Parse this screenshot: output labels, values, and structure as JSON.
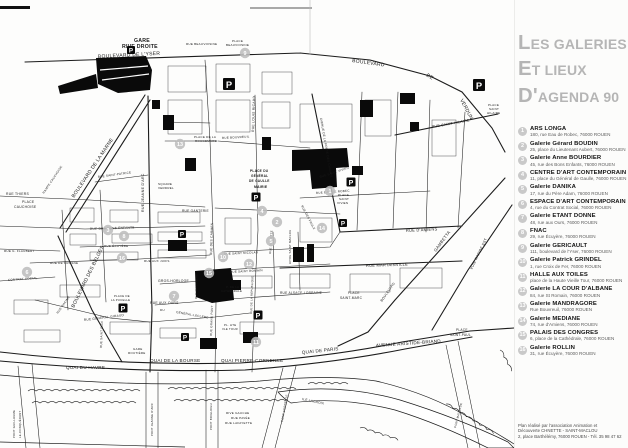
{
  "colors": {
    "ink": "#1c1c1c",
    "title_gray": "#b5b5b5",
    "marker_gray": "#bdbdbd",
    "legend_circle_gray": "#c9c9c9",
    "address_gray": "#5d5d5d",
    "parking_black": "#0a0a0a"
  },
  "page": {
    "title_lines": [
      "LES GALERIES",
      "ET LIEUX",
      "D'AGENDA 90"
    ],
    "credit_lines": [
      "Plan réalisé par l'association Animation et",
      "Découverte CHNETTE - SAINT-MACLOU",
      "2, place Barthélémy, 76000 ROUEN - Tél. 35 98 47 62"
    ]
  },
  "legend": {
    "entries": [
      {
        "num": "1",
        "name": "ARS LONGA",
        "address": "180, rue Eau de Robec, 76000 ROUEN"
      },
      {
        "num": "2",
        "name": "Galerie Gérard BOUDIN",
        "address": "25, place du Lieutenant Aubert, 76000 ROUEN"
      },
      {
        "num": "3",
        "name": "Galerie Anne BOURDIER",
        "address": "45, rue des Bons Enfants, 76000 ROUEN"
      },
      {
        "num": "4",
        "name": "CENTRE D'ART CONTEMPORAIN",
        "address": "11, place du Général de Gaulle, 76000 ROUEN"
      },
      {
        "num": "5",
        "name": "Galerie DANIKA",
        "address": "17, rue du Père Adam, 76000 ROUEN"
      },
      {
        "num": "6",
        "name": "ESPACE D'ART CONTEMPORAIN",
        "address": "4, rue du Contrat Social, 76000 ROUEN"
      },
      {
        "num": "7",
        "name": "Galerie ETANT DONNE",
        "address": "48, rue aux Ours, 76000 ROUEN"
      },
      {
        "num": "8",
        "name": "FNAC",
        "address": "29, rue Écuyère, 76000 ROUEN"
      },
      {
        "num": "9",
        "name": "Galerie GERICAULT",
        "address": "111, boulevard de l'Yser, 76000 ROUEN"
      },
      {
        "num": "10",
        "name": "Galerie Patrick GRINDEL",
        "address": "1, rue Croix de Fer, 76000 ROUEN"
      },
      {
        "num": "11",
        "name": "HALLE AUX TOILES",
        "address": "place de la Haute Vieille Tour, 76000 ROUEN"
      },
      {
        "num": "12",
        "name": "Galerie LA COUR D'ALBANE",
        "address": "84, rue St Romain, 76000 ROUEN"
      },
      {
        "num": "13",
        "name": "Galerie MANDRAGORE",
        "address": "Rue Bouvreuil, 76000 ROUEN"
      },
      {
        "num": "14",
        "name": "Galerie MEDIANE",
        "address": "74, rue d'Amiens, 76000 ROUEN"
      },
      {
        "num": "15",
        "name": "PALAIS DES CONGRES",
        "address": "6, place de la Cathédrale, 76000 ROUEN"
      },
      {
        "num": "16",
        "name": "Galerie ROLLIN",
        "address": "31, rue Écuyère, 76000 ROUEN"
      }
    ]
  },
  "map": {
    "parking_label": "P",
    "labels": [
      {
        "t": "GARE",
        "x": 134,
        "y": 42,
        "s": 5.2,
        "w": "bold"
      },
      {
        "t": "RIVE DROITE",
        "x": 122,
        "y": 48,
        "s": 5.2,
        "w": "bold"
      },
      {
        "t": "BOULEVARD DE L'YSER",
        "x": 98,
        "y": 58,
        "s": 5,
        "r": -3
      },
      {
        "t": "BOULEVARD",
        "x": 352,
        "y": 62,
        "s": 5,
        "r": 8
      },
      {
        "t": "DE",
        "x": 426,
        "y": 76,
        "s": 5,
        "r": 32
      },
      {
        "t": "VERDUN",
        "x": 460,
        "y": 100,
        "s": 5,
        "r": 62
      },
      {
        "t": "RUE BEAUVOISINE",
        "x": 186,
        "y": 45,
        "s": 3
      },
      {
        "t": "PLACE",
        "x": 232,
        "y": 42,
        "s": 3
      },
      {
        "t": "BEAUVOISINE",
        "x": 226,
        "y": 46,
        "s": 3
      },
      {
        "t": "BOULEVARD DE LA MARNE",
        "x": 74,
        "y": 198,
        "s": 5,
        "r": -56
      },
      {
        "t": "RAMPE CAUCHOISE",
        "x": 44,
        "y": 194,
        "s": 3,
        "r": -56
      },
      {
        "t": "PLACE",
        "x": 22,
        "y": 203,
        "s": 3.4
      },
      {
        "t": "CAUCHOISE",
        "x": 14,
        "y": 208,
        "s": 3.4
      },
      {
        "t": "BOULEVARD DES BELGES",
        "x": 74,
        "y": 308,
        "s": 5,
        "r": -64
      },
      {
        "t": "RUE JEANNE D'ARC",
        "x": 144,
        "y": 212,
        "s": 3.6,
        "r": -90
      },
      {
        "t": "RUE LOUIS RICARD",
        "x": 254,
        "y": 132,
        "s": 3.4,
        "r": -88
      },
      {
        "t": "AVENUE DE LA PORTE DES CHAMPS",
        "x": 320,
        "y": 118,
        "s": 3,
        "r": 80
      },
      {
        "t": "RUE SAINT HILAIRE",
        "x": 432,
        "y": 128,
        "s": 3.6,
        "r": -10
      },
      {
        "t": "PLACE",
        "x": 488,
        "y": 106,
        "s": 3
      },
      {
        "t": "SAINT",
        "x": 489,
        "y": 110,
        "s": 3
      },
      {
        "t": "HILAIRE",
        "x": 487,
        "y": 114,
        "s": 3
      },
      {
        "t": "PLACE DE LA",
        "x": 194,
        "y": 138,
        "s": 3
      },
      {
        "t": "ROUGEMARE",
        "x": 195,
        "y": 142,
        "s": 3
      },
      {
        "t": "RUE BOUVREUIL",
        "x": 222,
        "y": 139,
        "s": 3,
        "r": -3
      },
      {
        "t": "SQUARE",
        "x": 158,
        "y": 185,
        "s": 3
      },
      {
        "t": "VERDREL",
        "x": 158,
        "y": 189,
        "s": 3
      },
      {
        "t": "PLACE DU",
        "x": 250,
        "y": 172,
        "s": 3.2,
        "w": "bold"
      },
      {
        "t": "GÉNÉRAL",
        "x": 251,
        "y": 177,
        "s": 3.2,
        "w": "bold"
      },
      {
        "t": "DE GAULLE",
        "x": 249,
        "y": 182,
        "s": 3.2,
        "w": "bold"
      },
      {
        "t": "MAIRIE",
        "x": 254,
        "y": 188,
        "s": 3.4,
        "w": "bold"
      },
      {
        "t": "RUE THIERS",
        "x": 6,
        "y": 195,
        "s": 3.4
      },
      {
        "t": "RUE GANTERIE",
        "x": 182,
        "y": 212,
        "s": 3.2
      },
      {
        "t": "RUE SAINT-PATRICE",
        "x": 98,
        "y": 178,
        "s": 3,
        "r": -8
      },
      {
        "t": "RUE DES BONS ENFANTS",
        "x": 90,
        "y": 230,
        "s": 3.2,
        "r": -2
      },
      {
        "t": "RUE ÉCUYÈRE",
        "x": 104,
        "y": 247,
        "s": 3
      },
      {
        "t": "RUE AUX JUIFS",
        "x": 144,
        "y": 262,
        "s": 3
      },
      {
        "t": "RUE DE CROSNE",
        "x": 50,
        "y": 264,
        "s": 3
      },
      {
        "t": "RUE G. FLAUBERT",
        "x": 4,
        "y": 252,
        "s": 3
      },
      {
        "t": "CONTRAT SOCIAL",
        "x": 8,
        "y": 281,
        "s": 3,
        "r": -4
      },
      {
        "t": "RUE DES CARMES",
        "x": 212,
        "y": 255,
        "s": 3.2,
        "r": -88
      },
      {
        "t": "RUE DE LA RÉPUBLIQUE",
        "x": 252,
        "y": 314,
        "s": 2.8,
        "r": -88
      },
      {
        "t": "GROS-HORLOGE",
        "x": 158,
        "y": 282,
        "s": 3.4
      },
      {
        "t": "RUE AUX OURS",
        "x": 150,
        "y": 304,
        "s": 3.4
      },
      {
        "t": "RUE SAINT NICOLAS",
        "x": 224,
        "y": 255,
        "s": 3,
        "r": -3
      },
      {
        "t": "RUE SAINT ROMAIN",
        "x": 230,
        "y": 273,
        "s": 3,
        "r": -3
      },
      {
        "t": "RUE EAU DE ROBEC",
        "x": 316,
        "y": 194,
        "s": 3,
        "r": -4
      },
      {
        "t": "RUE DES FAULX",
        "x": 301,
        "y": 206,
        "s": 3,
        "r": 62
      },
      {
        "t": "RUE SAINT VIVIEN",
        "x": 320,
        "y": 178,
        "s": 3,
        "r": -18
      },
      {
        "t": "PLACE",
        "x": 338,
        "y": 196,
        "s": 3
      },
      {
        "t": "SAINT",
        "x": 339,
        "y": 200,
        "s": 3
      },
      {
        "t": "VIVIEN",
        "x": 337,
        "y": 204,
        "s": 3
      },
      {
        "t": "RUE D'AMIENS",
        "x": 406,
        "y": 232,
        "s": 4,
        "r": -3
      },
      {
        "t": "RUE MARTAINVILLE",
        "x": 366,
        "y": 267,
        "s": 4,
        "r": -2
      },
      {
        "t": "PLACE",
        "x": 348,
        "y": 294,
        "s": 3.2
      },
      {
        "t": "SAINT-MARC",
        "x": 340,
        "y": 299,
        "s": 3.2
      },
      {
        "t": "BOULEVARD",
        "x": 382,
        "y": 302,
        "s": 3.4,
        "r": -55
      },
      {
        "t": "GAMBETTA",
        "x": 436,
        "y": 252,
        "s": 4.2,
        "r": -54
      },
      {
        "t": "VOIE RAPIDE EST",
        "x": 472,
        "y": 270,
        "s": 3.6,
        "r": -64
      },
      {
        "t": "RUE GÉNÉRAL GIRAUD",
        "x": 84,
        "y": 321,
        "s": 3.2,
        "r": -7
      },
      {
        "t": "PLACE DE",
        "x": 114,
        "y": 297,
        "s": 2.8
      },
      {
        "t": "LA PUCELLE",
        "x": 111,
        "y": 301,
        "s": 2.8
      },
      {
        "t": "GARE",
        "x": 133,
        "y": 350,
        "s": 3
      },
      {
        "t": "ROUTIÈRE",
        "x": 128,
        "y": 354,
        "s": 3
      },
      {
        "t": "RUE GRAND PONT",
        "x": 212,
        "y": 336,
        "s": 3,
        "r": -88
      },
      {
        "t": "RUE SAINT ELOI",
        "x": 102,
        "y": 348,
        "s": 3,
        "r": -88
      },
      {
        "t": "RUE RACINE",
        "x": 58,
        "y": 314,
        "s": 3,
        "r": -55
      },
      {
        "t": "RUE MASSACRE",
        "x": 197,
        "y": 299,
        "s": 2.8,
        "r": -88
      },
      {
        "t": "DU",
        "x": 160,
        "y": 311,
        "s": 3
      },
      {
        "t": "GÉNÉRAL-LECLERC",
        "x": 176,
        "y": 313,
        "s": 3,
        "r": 10
      },
      {
        "t": "P. DE LA",
        "x": 226,
        "y": 288,
        "s": 2.8
      },
      {
        "t": "CATHÉDRALE",
        "x": 221,
        "y": 292,
        "s": 2.8
      },
      {
        "t": "PL. HTE",
        "x": 224,
        "y": 326,
        "s": 2.8
      },
      {
        "t": "VLE TOUR",
        "x": 222,
        "y": 330,
        "s": 2.8
      },
      {
        "t": "RUE ALSACE-LORRAINE",
        "x": 280,
        "y": 294,
        "s": 3.2
      },
      {
        "t": "AITRE SAINT MACLOU",
        "x": 291,
        "y": 264,
        "s": 2.8,
        "r": -90
      },
      {
        "t": "RUE DAMIETTE",
        "x": 271,
        "y": 254,
        "s": 2.8,
        "r": -86
      },
      {
        "t": "QUAI DU HAVRE",
        "x": 66,
        "y": 369,
        "s": 4.6
      },
      {
        "t": "QUAI DE LA BOURSE",
        "x": 150,
        "y": 362,
        "s": 4.6
      },
      {
        "t": "QUAI PIERRE-CORNEILLE",
        "x": 221,
        "y": 362,
        "s": 4.6
      },
      {
        "t": "QUAI DE PARIS",
        "x": 302,
        "y": 354,
        "s": 4.6,
        "r": -6
      },
      {
        "t": "AVENUE ARISTIDE-BRIAND",
        "x": 376,
        "y": 347,
        "s": 4.6,
        "r": -4
      },
      {
        "t": "PLACE",
        "x": 456,
        "y": 331,
        "s": 3.2
      },
      {
        "t": "SAINT-PAUL",
        "x": 450,
        "y": 336,
        "s": 3.2
      },
      {
        "t": "PONT GUILLAUME",
        "x": 15,
        "y": 438,
        "s": 2.8,
        "r": -90
      },
      {
        "t": "LE-CONQUÉRANT",
        "x": 21,
        "y": 438,
        "s": 2.8,
        "r": -90
      },
      {
        "t": "PONT JEANNE D'ARC",
        "x": 153,
        "y": 436,
        "s": 2.8,
        "r": -90
      },
      {
        "t": "PONT BOIELDIEU",
        "x": 212,
        "y": 430,
        "s": 2.8,
        "r": -90
      },
      {
        "t": "PONT CORNEILLE",
        "x": 283,
        "y": 422,
        "s": 2.8,
        "r": -80
      },
      {
        "t": "PONT MATHILDE",
        "x": 456,
        "y": 428,
        "s": 2.8,
        "r": -76
      },
      {
        "t": "ILE LACROIX",
        "x": 302,
        "y": 400,
        "s": 3.2,
        "r": 12
      },
      {
        "t": "RIVE GAUCHE",
        "x": 226,
        "y": 414,
        "s": 3
      },
      {
        "t": "RUE PAVÉE",
        "x": 231,
        "y": 419,
        "s": 3
      },
      {
        "t": "RUE LAFAYETTE",
        "x": 225,
        "y": 424,
        "s": 3
      }
    ],
    "markers": [
      {
        "n": "1",
        "x": 330,
        "y": 191
      },
      {
        "n": "2",
        "x": 277,
        "y": 222
      },
      {
        "n": "3",
        "x": 108,
        "y": 230
      },
      {
        "n": "4",
        "x": 262,
        "y": 211
      },
      {
        "n": "5",
        "x": 271,
        "y": 241
      },
      {
        "n": "6",
        "x": 27,
        "y": 272
      },
      {
        "n": "7",
        "x": 174,
        "y": 296
      },
      {
        "n": "8",
        "x": 124,
        "y": 236
      },
      {
        "n": "9",
        "x": 245,
        "y": 53
      },
      {
        "n": "10",
        "x": 223,
        "y": 257
      },
      {
        "n": "11",
        "x": 256,
        "y": 342
      },
      {
        "n": "12",
        "x": 249,
        "y": 264
      },
      {
        "n": "13",
        "x": 180,
        "y": 144
      },
      {
        "n": "14",
        "x": 322,
        "y": 228
      },
      {
        "n": "15",
        "x": 209,
        "y": 273
      },
      {
        "n": "16",
        "x": 122,
        "y": 258
      }
    ],
    "parkings": [
      {
        "x": 131,
        "y": 50,
        "s": 8
      },
      {
        "x": 229,
        "y": 84,
        "s": 12
      },
      {
        "x": 479,
        "y": 85,
        "s": 12
      },
      {
        "x": 256,
        "y": 197,
        "s": 9
      },
      {
        "x": 182,
        "y": 234,
        "s": 8
      },
      {
        "x": 351,
        "y": 182,
        "s": 9
      },
      {
        "x": 343,
        "y": 223,
        "s": 8
      },
      {
        "x": 123,
        "y": 308,
        "s": 9
      },
      {
        "x": 185,
        "y": 337,
        "s": 8
      },
      {
        "x": 258,
        "y": 315,
        "s": 9
      }
    ]
  }
}
